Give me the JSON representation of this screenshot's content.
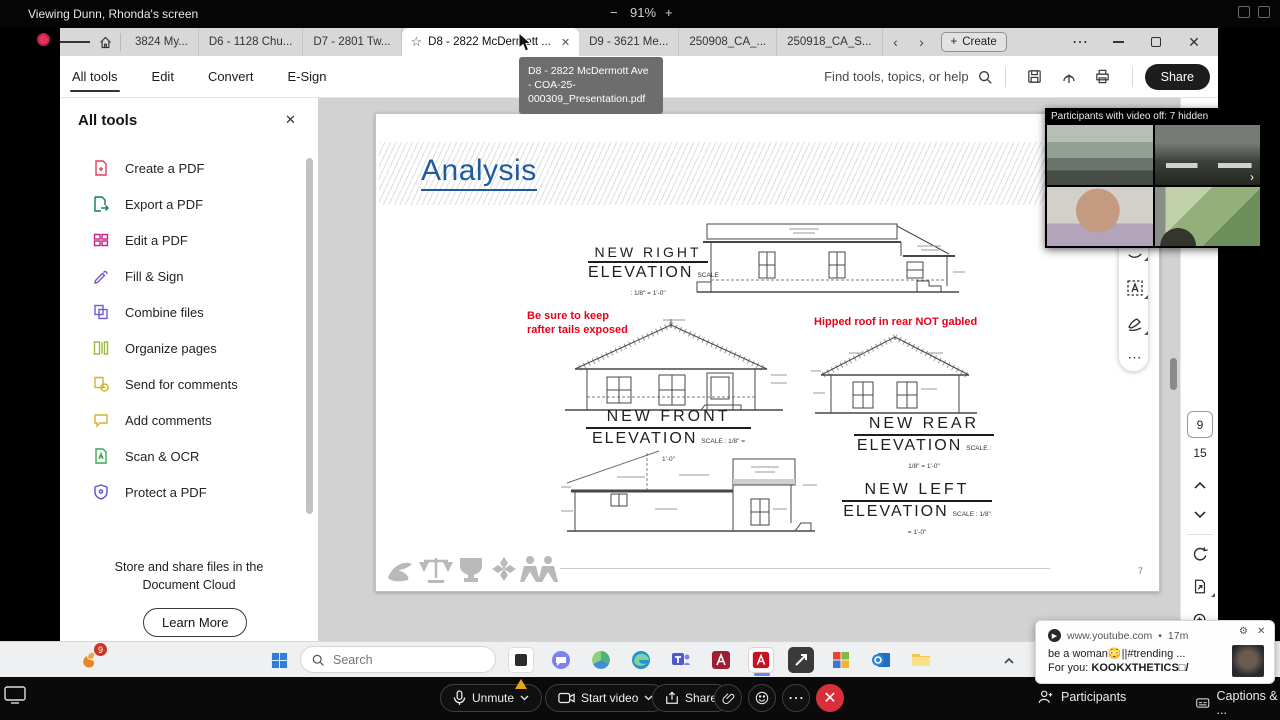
{
  "banner": {
    "viewing": "Viewing Dunn, Rhonda's screen",
    "zoom_level": "91%"
  },
  "tab_bar": {
    "tabs": [
      {
        "label": "3824 My..."
      },
      {
        "label": "D6 - 1128 Chu..."
      },
      {
        "label": "D7 - 2801 Tw..."
      },
      {
        "label": "D8 - 2822 McDermott ..."
      },
      {
        "label": "D9 - 3621 Me..."
      },
      {
        "label": "250908_CA_..."
      },
      {
        "label": "250918_CA_S..."
      }
    ],
    "create_label": "Create"
  },
  "tooltip": {
    "text": "D8 - 2822 McDermott Ave - COA-25-000309_Presentation.pdf"
  },
  "menu_bar": {
    "items": [
      "All tools",
      "Edit",
      "Convert",
      "E-Sign"
    ],
    "find_label": "Find tools, topics, or help",
    "share_label": "Share"
  },
  "sidebar": {
    "title": "All tools",
    "items": [
      {
        "label": "Create a PDF",
        "color": "#E23F57"
      },
      {
        "label": "Export a PDF",
        "color": "#0E7A63"
      },
      {
        "label": "Edit a PDF",
        "color": "#C81F83"
      },
      {
        "label": "Fill & Sign",
        "color": "#7A52C7"
      },
      {
        "label": "Combine files",
        "color": "#6E5BD6"
      },
      {
        "label": "Organize pages",
        "color": "#9CBB3B"
      },
      {
        "label": "Send for comments",
        "color": "#D6B428"
      },
      {
        "label": "Add comments",
        "color": "#D6B428"
      },
      {
        "label": "Scan & OCR",
        "color": "#3FA756"
      },
      {
        "label": "Protect a PDF",
        "color": "#5F54D6"
      }
    ],
    "footer": "Store and share files in the Document Cloud",
    "learn_more": "Learn More"
  },
  "document": {
    "slide_title": "Analysis",
    "note_front_line1": "Be sure to keep",
    "note_front_line2": "rafter tails exposed",
    "note_rear": "Hipped roof in rear NOT gabled",
    "elevations": {
      "right": {
        "l1": "NEW RIGHT",
        "l2": "ELEVATION",
        "scale": "SCALE : 1/8\" = 1'-0\""
      },
      "front": {
        "l1": "NEW  FRONT",
        "l2": "ELEVATION",
        "scale": "SCALE : 1/8\" = 1'-0\""
      },
      "rear": {
        "l1": "NEW  REAR",
        "l2": "ELEVATION",
        "scale": "SCALE : 1/8\" = 1'-0\""
      },
      "left": {
        "l1": "NEW  LEFT",
        "l2": "ELEVATION",
        "scale": "SCALE : 1/8\" = 1'-0\""
      }
    },
    "page_number": "7"
  },
  "nav": {
    "current_page": "9",
    "total_pages": "15"
  },
  "participants": {
    "header": "Participants with video off: 7 hidden"
  },
  "notification": {
    "source": "www.youtube.com",
    "separator": "•",
    "time": "17m",
    "line1": "be a woman😳||#trending ...",
    "line2_prefix": "For you: ",
    "line2_bold": "KOOKXTHETICS□/"
  },
  "taskbar": {
    "search_placeholder": "Search",
    "badge": "9"
  },
  "meeting_bar": {
    "unmute": "Unmute",
    "start_video": "Start video",
    "share": "Share",
    "participants": "Participants",
    "captions": "Captions & ..."
  }
}
